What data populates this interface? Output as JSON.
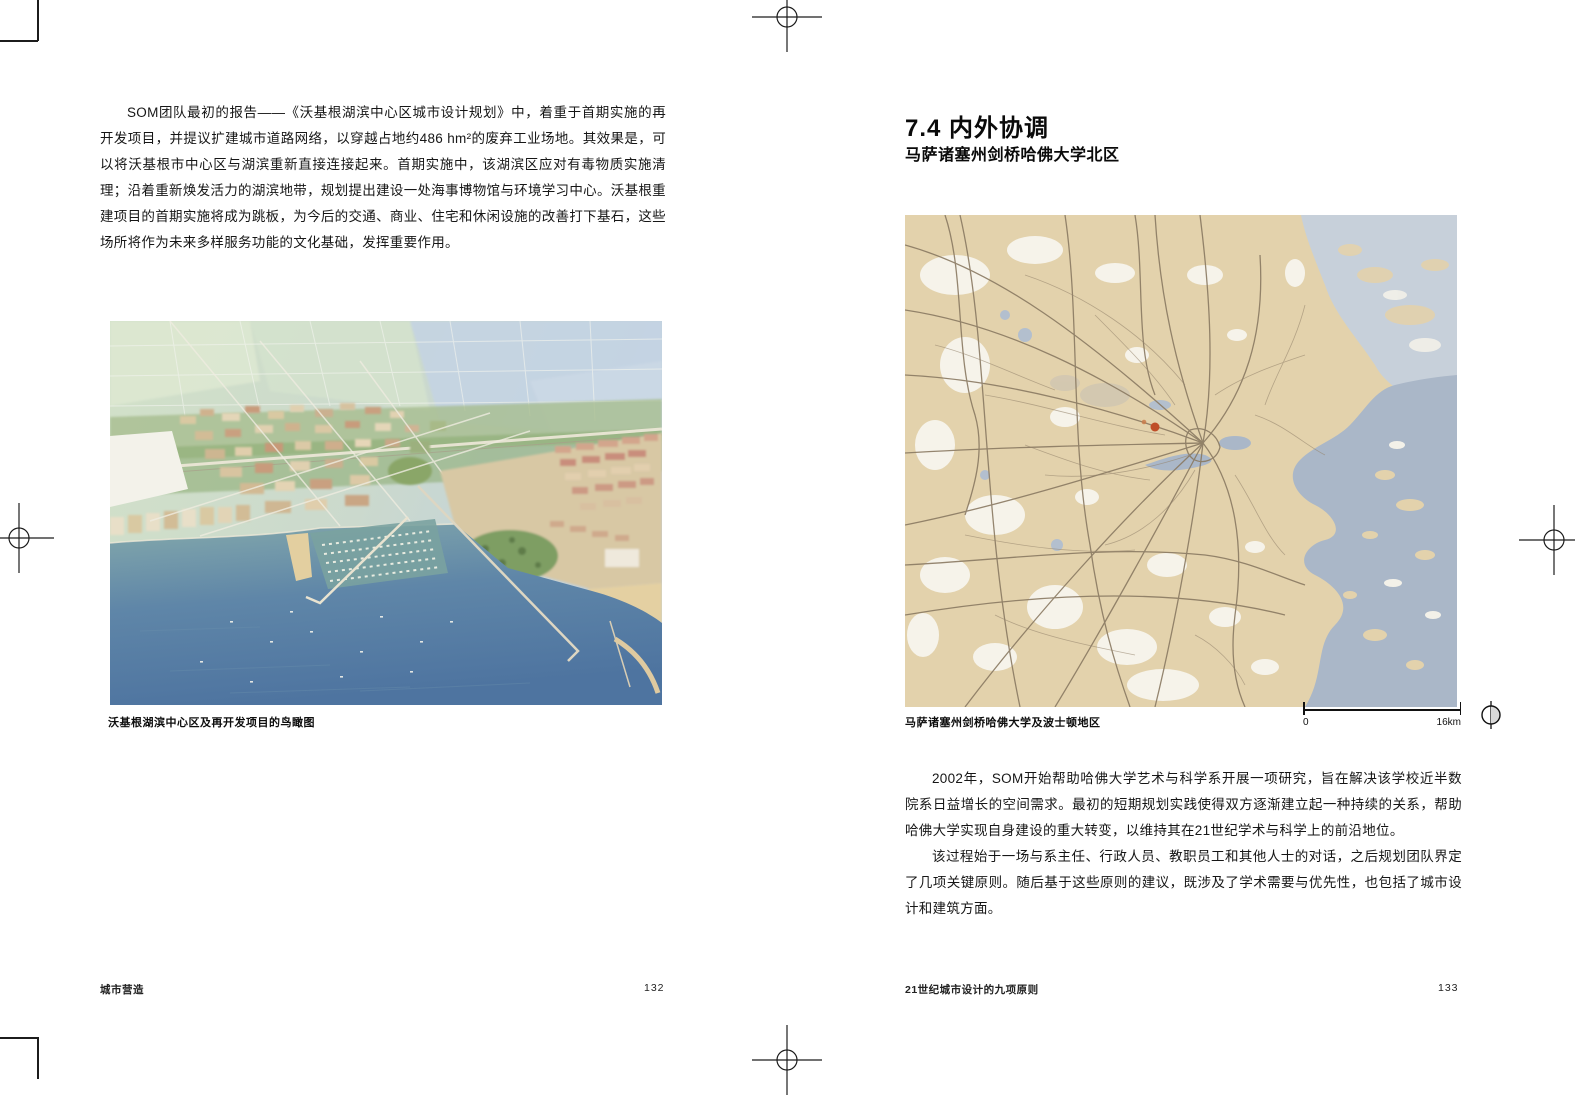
{
  "left_page": {
    "paragraph": "SOM团队最初的报告——《沃基根湖滨中心区城市设计规划》中，着重于首期实施的再开发项目，并提议扩建城市道路网络，以穿越占地约486 hm²的废弃工业场地。其效果是，可以将沃基根市中心区与湖滨重新直接连接起来。首期实施中，该湖滨区应对有毒物质实施清理；沿着重新焕发活力的湖滨地带，规划提出建设一处海事博物馆与环境学习中心。沃基根重建项目的首期实施将成为跳板，为今后的交通、商业、住宅和休闲设施的改善打下基石，这些场所将作为未来多样服务功能的文化基础，发挥重要作用。",
    "image_caption": "沃基根湖滨中心区及再开发项目的鸟瞰图",
    "footer": "城市营造",
    "page_number": "132"
  },
  "right_page": {
    "heading": "7.4 内外协调",
    "subheading": "马萨诸塞州剑桥哈佛大学北区",
    "map_caption": "马萨诸塞州剑桥哈佛大学及波士顿地区",
    "scale_bar": {
      "start_label": "0",
      "end_label": "16km"
    },
    "paragraphs": [
      "2002年，SOM开始帮助哈佛大学艺术与科学系开展一项研究，旨在解决该学校近半数院系日益增长的空间需求。最初的短期规划实践使得双方逐渐建立起一种持续的关系，帮助哈佛大学实现自身建设的重大转变，以维持其在21世纪学术与科学上的前沿地位。",
      "该过程始于一场与系主任、行政人员、教职员工和其他人士的对话，之后规划团队界定了几项关键原则。随后基于这些原则的建议，既涉及了学术需要与优先性，也包括了城市设计和建筑方面。"
    ],
    "footer": "21世纪城市设计的九项原则",
    "page_number": "133"
  },
  "colors": {
    "map_land": "#e3d2ac",
    "map_water": "#aab7c8",
    "map_road": "#8a7a62",
    "map_highlight_dot": "#bf4e28",
    "aerial_water_deep": "#4e74a0",
    "aerial_water_shallow": "#84a9ab"
  }
}
